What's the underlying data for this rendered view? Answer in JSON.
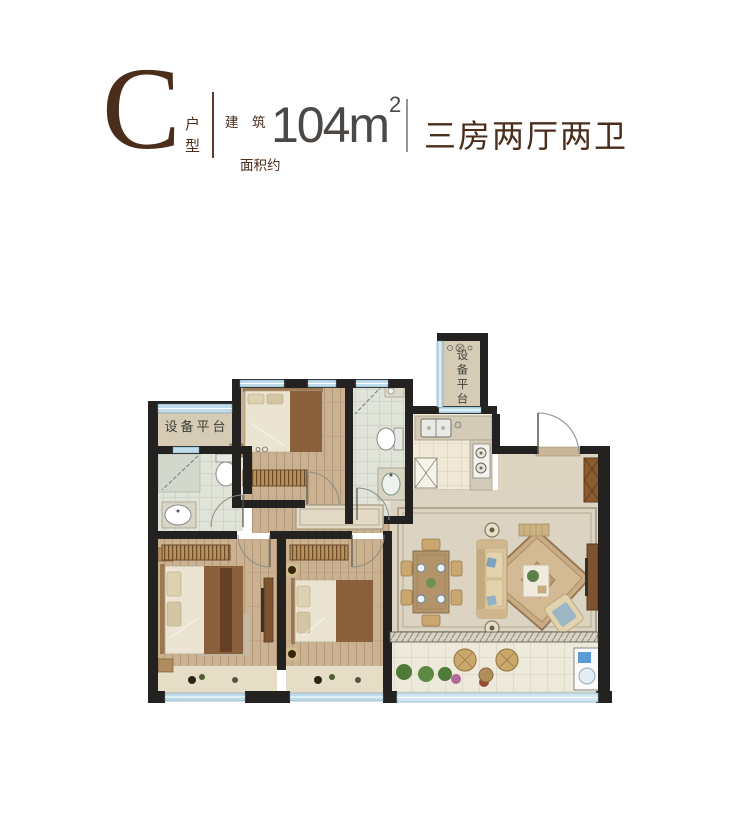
{
  "header": {
    "letter": "C",
    "letter_caption": "户型",
    "area_label_line1": "建　筑",
    "area_label_line2": "面积约",
    "area_value": "104m",
    "area_exponent": "2",
    "layout_text": "三房两厅两卫"
  },
  "plan": {
    "labels": {
      "equipment_platform_left": "设备平台",
      "equipment_platform_top": "设备平台"
    }
  },
  "colors": {
    "brand_brown": "#4A2D1B",
    "area_gray": "#4C4845",
    "wall_black": "#232220",
    "window_blue": "#BFDCEA",
    "wood_floor": "#C9B191",
    "living_floor": "#DCD4C3",
    "bath_floor": "#E0E3D8",
    "kitchen_floor": "#F0E9D7",
    "platform_beige": "#D6CCB6",
    "furniture_brown": "#7D5330",
    "blanket_brown": "#8A5F3C"
  }
}
